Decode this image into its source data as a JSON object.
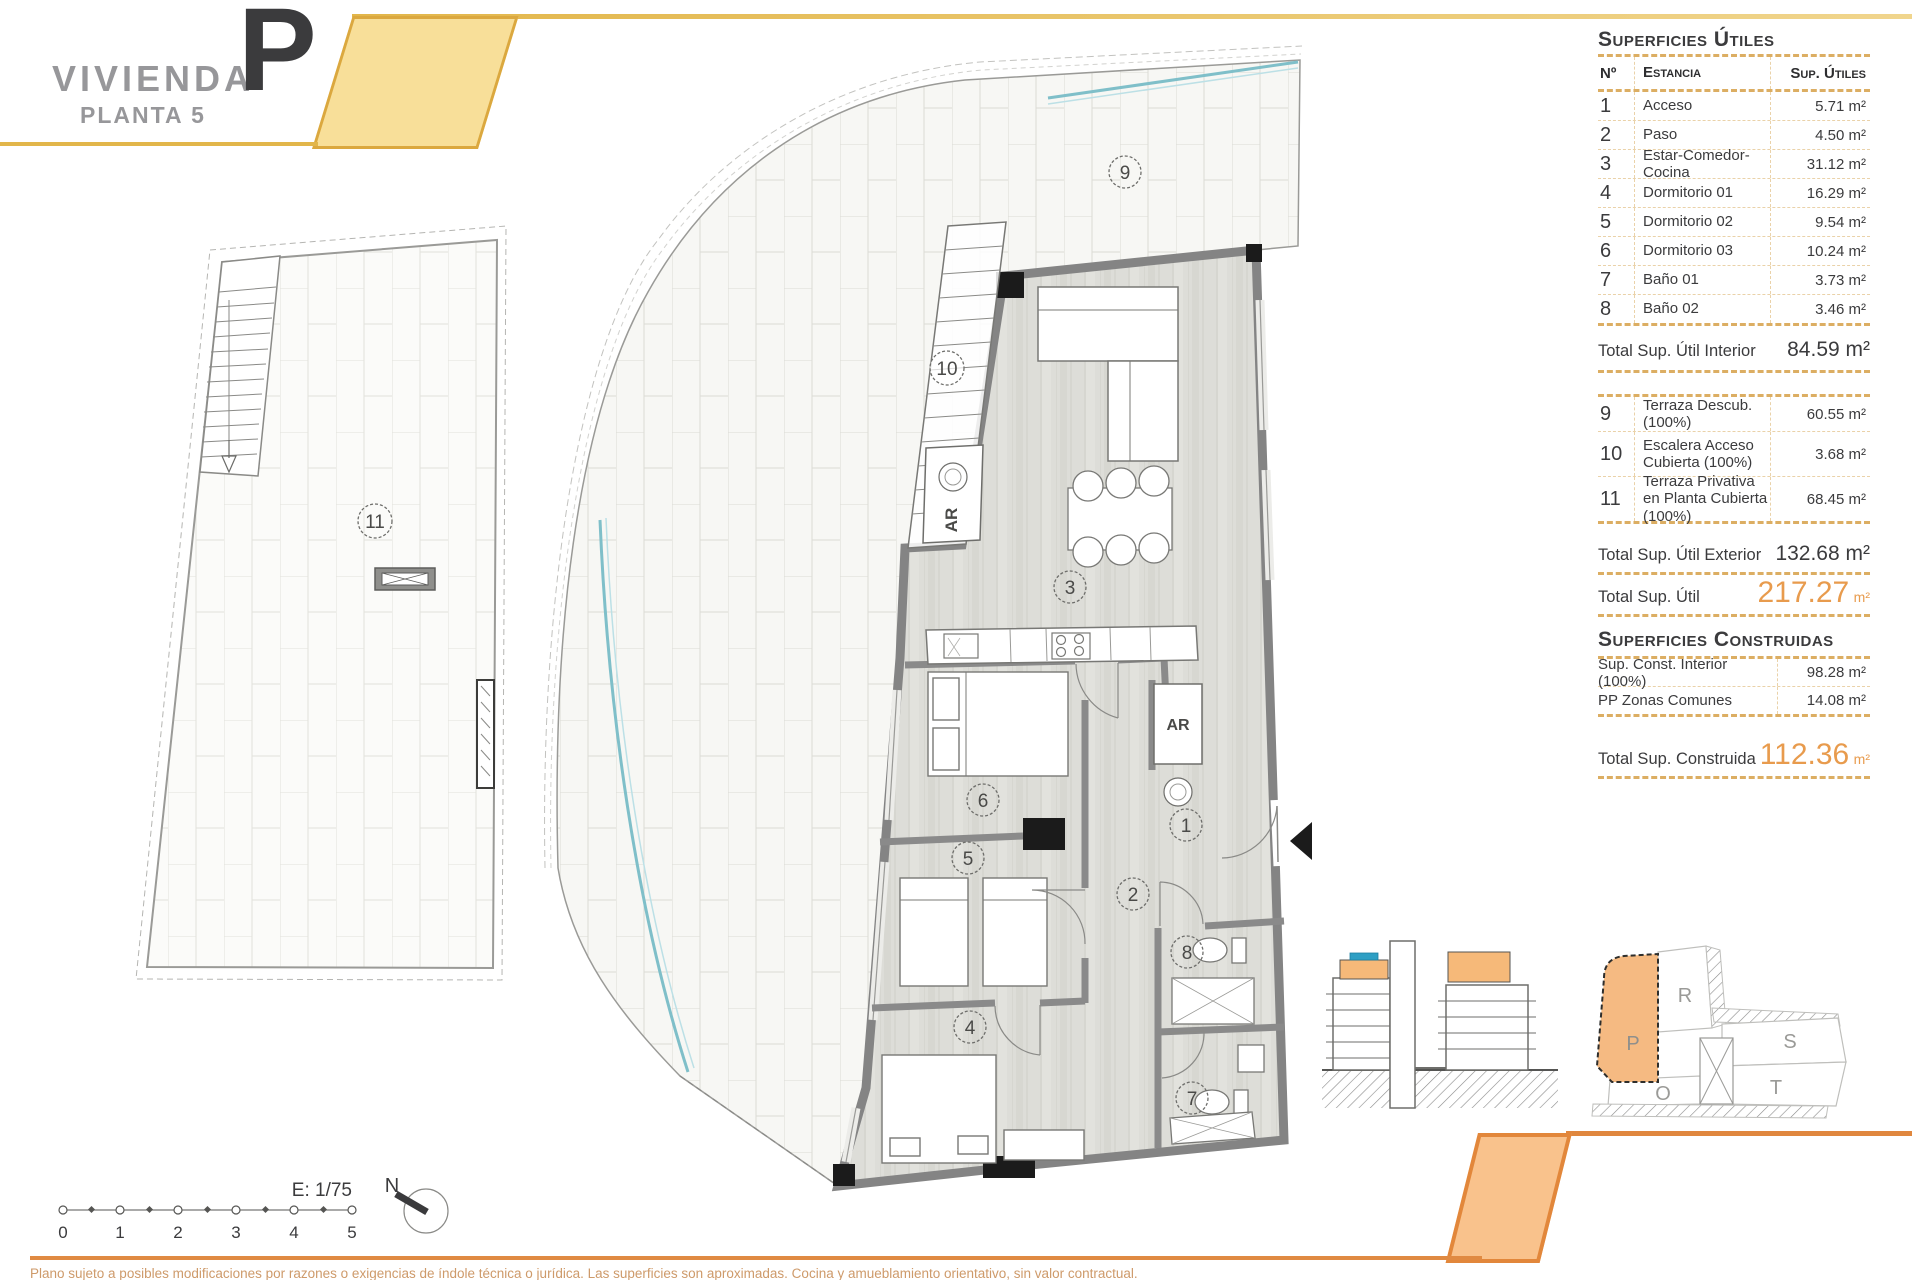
{
  "header": {
    "project": "VIVIENDA",
    "floor": "PLANTA 5",
    "unit": "P"
  },
  "surfaces_utiles": {
    "title": "Superficies Útiles",
    "columns": {
      "num": "Nº",
      "room": "Estancia",
      "area": "Sup. Útiles"
    },
    "rows": [
      {
        "num": "1",
        "room": "Acceso",
        "area": "5.71 m²"
      },
      {
        "num": "2",
        "room": "Paso",
        "area": "4.50 m²"
      },
      {
        "num": "3",
        "room": "Estar-Comedor-Cocina",
        "area": "31.12 m²"
      },
      {
        "num": "4",
        "room": "Dormitorio 01",
        "area": "16.29 m²"
      },
      {
        "num": "5",
        "room": "Dormitorio 02",
        "area": "9.54 m²"
      },
      {
        "num": "6",
        "room": "Dormitorio 03",
        "area": "10.24 m²"
      },
      {
        "num": "7",
        "room": "Baño 01",
        "area": "3.73 m²"
      },
      {
        "num": "8",
        "room": "Baño 02",
        "area": "3.46 m²"
      }
    ],
    "total_interior": {
      "label": "Total Sup. Útil Interior",
      "value": "84.59 m²"
    },
    "exterior_rows": [
      {
        "num": "9",
        "room": "Terraza Descub.(100%)",
        "area": "60.55 m²"
      },
      {
        "num": "10",
        "room": "Escalera Acceso Cubierta (100%)",
        "area": "3.68 m²"
      },
      {
        "num": "11",
        "room": "Terraza Privativa en Planta Cubierta (100%)",
        "area": "68.45 m²"
      }
    ],
    "total_exterior": {
      "label": "Total Sup. Útil Exterior",
      "value": "132.68 m²"
    },
    "total_util": {
      "label": "Total Sup. Útil",
      "value": "217.27",
      "unit": "m²"
    }
  },
  "surfaces_construidas": {
    "title": "Superficies Construidas",
    "rows": [
      {
        "label": "Sup. Const. Interior (100%)",
        "value": "98.28 m²"
      },
      {
        "label": "PP Zonas Comunes",
        "value": "14.08 m²"
      }
    ],
    "total": {
      "label": "Total Sup. Construida",
      "value": "112.36",
      "unit": "m²"
    }
  },
  "plan": {
    "room_numbers": [
      "1",
      "2",
      "3",
      "4",
      "5",
      "6",
      "7",
      "8",
      "9",
      "10",
      "11"
    ],
    "ar_label": "AR"
  },
  "site_key": {
    "p": "P",
    "r": "R",
    "s": "S",
    "t": "T",
    "o": "O"
  },
  "scalebar": {
    "scale_label": "E: 1/75",
    "ticks": [
      "0",
      "1",
      "2",
      "3",
      "4",
      "5"
    ]
  },
  "compass": {
    "north_label": "N"
  },
  "footer": {
    "disclaimer": "Plano sujeto a posibles modificaciones por razones o exigencias de índole técnica o jurídica. Las superficies son aproximadas. Cocina y amueblamiento orientativo, sin valor contractual."
  },
  "colors": {
    "accent_yellow": "#E2B64A",
    "accent_orange": "#E0873E",
    "total_orange": "#E89B4D",
    "section_highlight": "#F6B979",
    "section_blue": "#2E9FC4",
    "balustrade_teal": "#7FBFC9",
    "wall_gray": "#848484"
  }
}
